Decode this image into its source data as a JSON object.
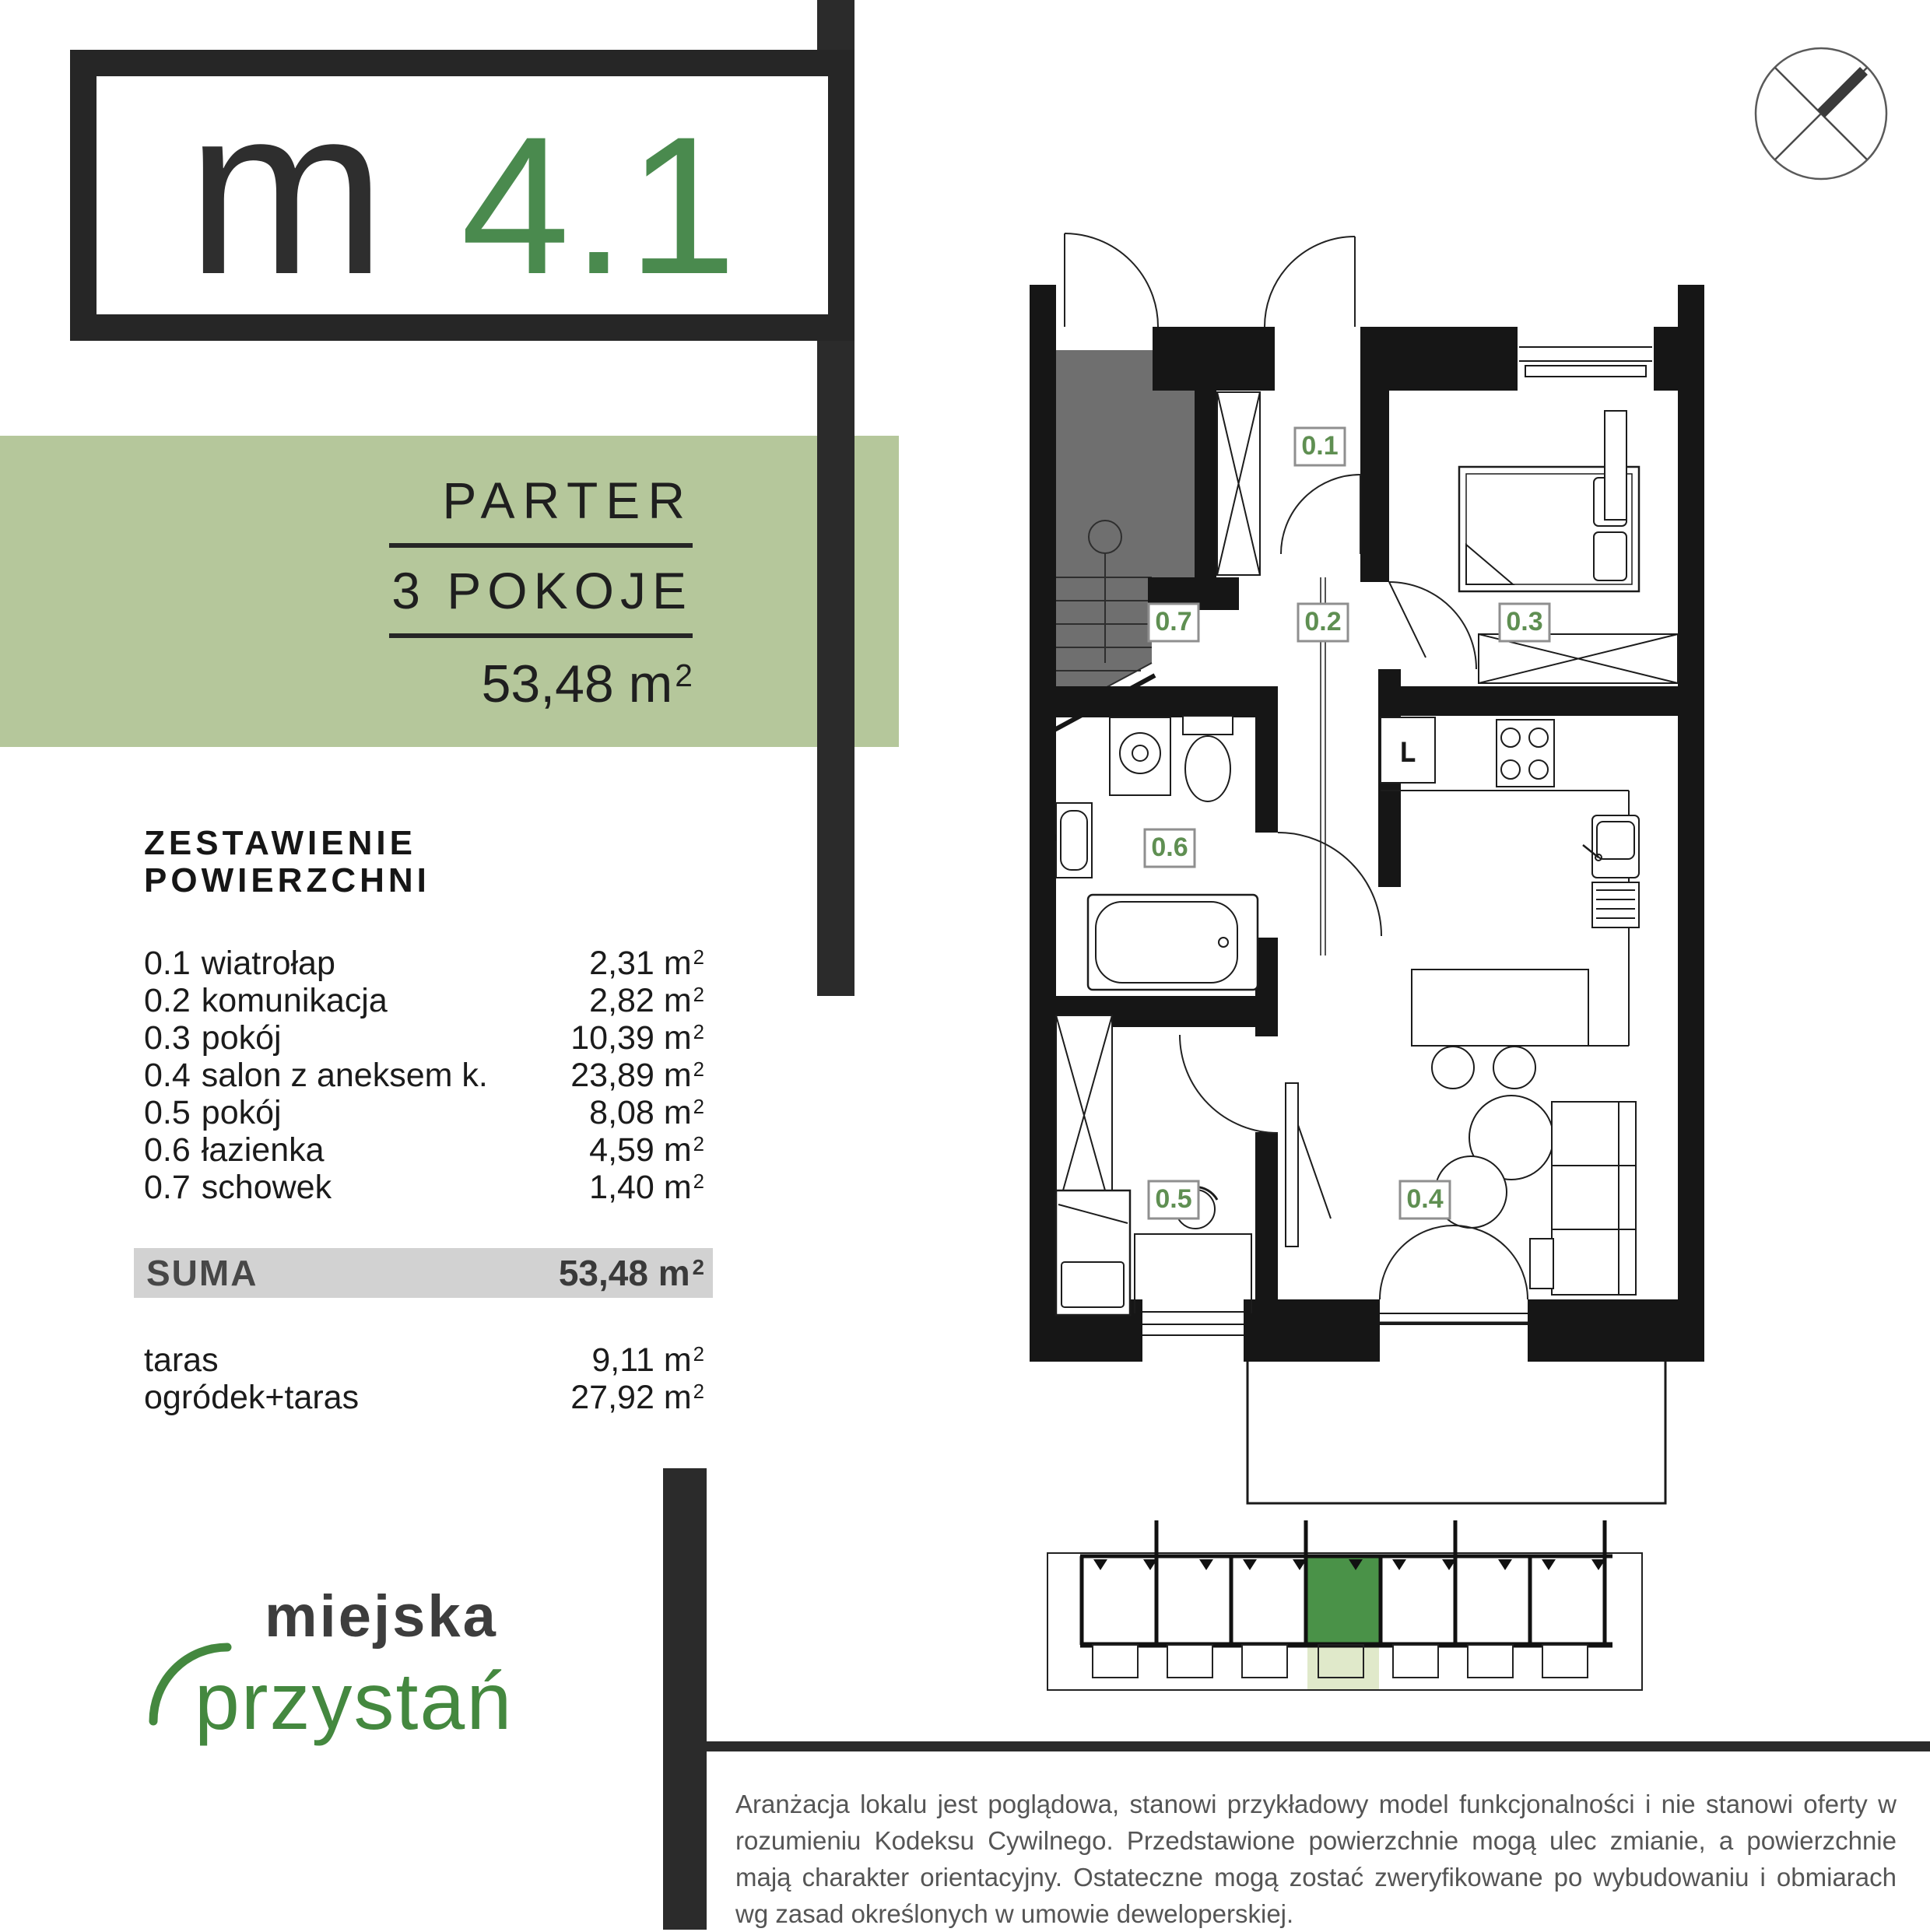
{
  "units": {
    "base": "m",
    "sup": "2"
  },
  "unit_card": {
    "letter": "m",
    "number": "4.1"
  },
  "summary_band": {
    "floor": "PARTER",
    "rooms": "3 POKOJE",
    "area": "53,48"
  },
  "area_table": {
    "title": "ZESTAWIENIE POWIERZCHNI",
    "rows": [
      {
        "code": "0.1",
        "name": "wiatrołap",
        "value": "2,31"
      },
      {
        "code": "0.2",
        "name": "komunikacja",
        "value": "2,82"
      },
      {
        "code": "0.3",
        "name": "pokój",
        "value": "10,39"
      },
      {
        "code": "0.4",
        "name": "salon z aneksem k.",
        "value": "23,89"
      },
      {
        "code": "0.5",
        "name": "pokój",
        "value": "8,08"
      },
      {
        "code": "0.6",
        "name": "łazienka",
        "value": "4,59"
      },
      {
        "code": "0.7",
        "name": "schowek",
        "value": "1,40"
      }
    ],
    "suma_label": "SUMA",
    "suma_value": "53,48",
    "extras": [
      {
        "name": "taras",
        "value": "9,11"
      },
      {
        "name": "ogródek+taras",
        "value": "27,92"
      }
    ]
  },
  "floor_plan": {
    "labels": {
      "l01": "0.1",
      "l02": "0.2",
      "l03": "0.3",
      "l04": "0.4",
      "l05": "0.5",
      "l06": "0.6",
      "l07": "0.7"
    },
    "fridge": "L"
  },
  "brand": {
    "line1": "miejska",
    "line2": "przystań"
  },
  "disclaimer": "Aranżacja lokalu jest poglądowa, stanowi przykładowy model funkcjonalności i nie stanowi oferty w rozumieniu Kodeksu Cywilnego. Przedstawione powierzchnie mogą ulec zmianie, a powierzchnie mają charakter orientacyjny. Ostateczne mogą zostać zweryfikowane po wybudowaniu i obmiarach wg zasad określonych w umowie deweloperskiej.",
  "colors": {
    "dark": "#262626",
    "accent_green": "#4a8a4e",
    "band_green": "#b5c79b",
    "label_green": "#5f8f52",
    "site_green": "#4a9248",
    "site_light_green": "#e0e9ca",
    "suma_gray": "#d2d2d2",
    "stair_gray": "#6f6f6f"
  }
}
